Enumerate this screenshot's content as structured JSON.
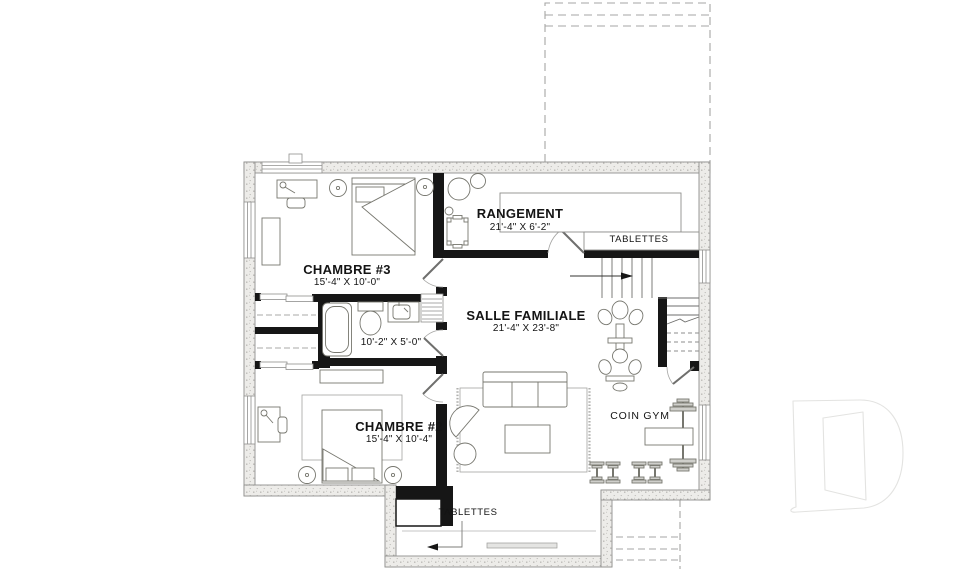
{
  "rooms": {
    "rangement": {
      "name": "RANGEMENT",
      "dims": "21'-4\" X 6'-2\""
    },
    "chambre3": {
      "name": "CHAMBRE #3",
      "dims": "15'-4\" X 10'-0\""
    },
    "salle_familiale": {
      "name": "SALLE FAMILIALE",
      "dims": "21'-4\" X 23'-8\""
    },
    "salle_de_bain": {
      "dims": "10'-2\" X 5'-0\""
    },
    "chambre2": {
      "name": "CHAMBRE #2",
      "dims": "15'-4\" X 10'-4\""
    },
    "coin_gym": {
      "name": "COIN GYM"
    }
  },
  "annotations": {
    "tablettes_rangement": "TABLETTES",
    "tablettes_alcove": "TABLETTES"
  },
  "colors": {
    "background": "#ffffff",
    "interior_wall": "#161616",
    "exterior_wall_fill": "#edece9",
    "exterior_wall_edge": "#8f8f8d",
    "furniture_line": "#77776f",
    "dashed_line": "#a9a9a7",
    "text": "#141414",
    "watermark": "#e3e3e1"
  }
}
